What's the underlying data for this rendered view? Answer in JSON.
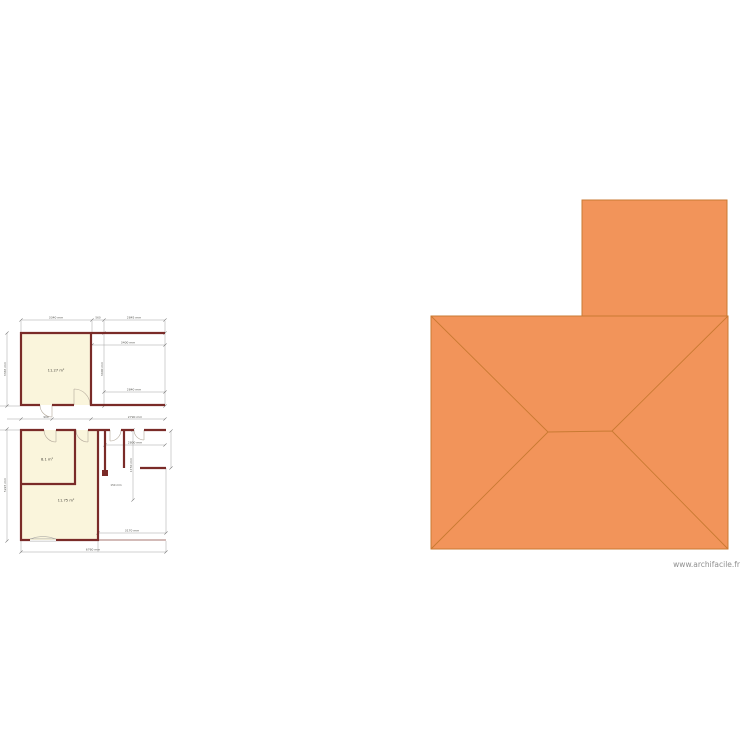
{
  "watermark": {
    "text": "www.archifacile.fr"
  },
  "colors": {
    "roof_fill": "#F2945A",
    "roof_line": "#C97A33",
    "wall": "#7A2B28",
    "room_fill": "#FAF5DC"
  },
  "rooms": {
    "top": {
      "area": "11.27 m²"
    },
    "middle": {
      "area": "8.1 m²"
    },
    "bottom": {
      "area": "11.75 m²"
    }
  },
  "dims": {
    "top_a": "3340 mm",
    "top_b": "560",
    "top_c": "2845 mm",
    "left_top": "3365 mm",
    "left_bottom": "5225 mm",
    "tr_h1": "3400 mm",
    "tr_h2": "2840 mm",
    "tr_v": "3400 mm",
    "corridor_a": "900",
    "corridor_b": "2790 mm",
    "br_h": "2800 mm",
    "br_v": "1750 mm",
    "br_small": "150 mm",
    "bottom_a": "3170 mm",
    "bottom_b": "6760 mm"
  }
}
